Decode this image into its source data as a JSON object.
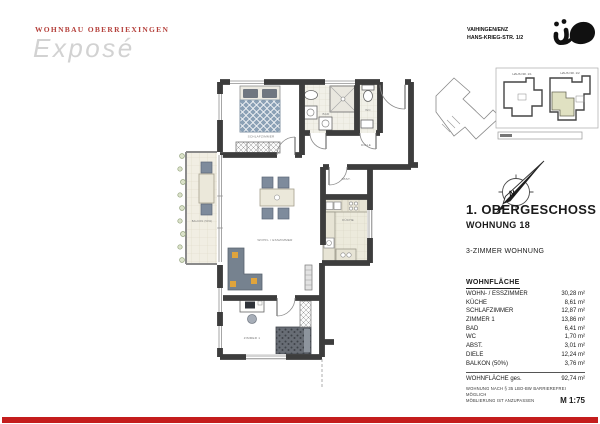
{
  "header": {
    "project_name": "WOHNBAU OBERRIEXINGEN",
    "document_title": "Exposé"
  },
  "address": {
    "city": "VAIHINGEN/ENZ",
    "street": "HANS-KRIEG-STR. 1/2"
  },
  "site_plan": {
    "haus_1_label": "HAUS NR. 1/1",
    "haus_2_label": "HAUS NR. 1/2"
  },
  "compass": {
    "label": "N"
  },
  "unit": {
    "floor": "1. OBERGESCHOSS",
    "number": "WOHNUNG 18",
    "type": "3-ZIMMER WOHNUNG"
  },
  "area_table": {
    "title": "WOHNFLÄCHE",
    "rows": [
      {
        "label": "WOHN- / ESSZIMMER",
        "value": "30,28 m²"
      },
      {
        "label": "KÜCHE",
        "value": "8,61 m²"
      },
      {
        "label": "SCHLAFZIMMER",
        "value": "12,87 m²"
      },
      {
        "label": "ZIMMER 1",
        "value": "13,86 m²"
      },
      {
        "label": "BAD",
        "value": "6,41 m²"
      },
      {
        "label": "WC",
        "value": "1,70 m²"
      },
      {
        "label": "ABST.",
        "value": "3,01 m²"
      },
      {
        "label": "DIELE",
        "value": "12,24 m²"
      },
      {
        "label": "BALKON (50%)",
        "value": "3,76 m²"
      }
    ],
    "total": {
      "label": "WOHNFLÄCHE ges.",
      "value": "92,74 m²"
    }
  },
  "floor_plan": {
    "rooms": {
      "schlafzimmer": "SCHLAFZIMMER",
      "bad": "BAD",
      "wc": "WC",
      "diele": "DIELE",
      "abst": "ABST.",
      "kueche": "KÜCHE",
      "wohn": "WOHN- / ESSZIMMER",
      "zimmer1": "ZIMMER 1",
      "balkon": "BALKON (50%)"
    }
  },
  "notes": {
    "line1": "WOHNUNG NACH § 35 LBO-BW BARRIEREFREI MÖGLICH",
    "line2": "MÖBLIERUNG IST ANZUPASSEN",
    "scale": "M 1:75"
  },
  "colors": {
    "accent_red": "#c41d1d",
    "title_red": "#b5413c",
    "expose_gray": "#d2d2d2",
    "site_highlight": "#e0e1c2"
  }
}
